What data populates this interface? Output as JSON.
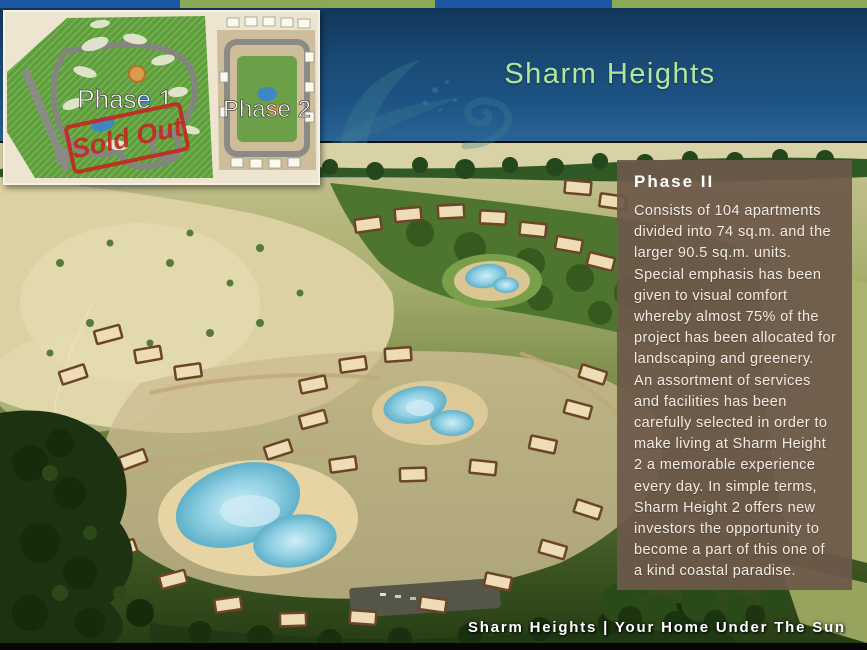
{
  "slide": {
    "title": "Sharm Heights",
    "tagline": "Sharm Heights | Your Home Under The Sun"
  },
  "site_map": {
    "phase1_label": "Phase 1",
    "phase2_label": "Phase 2",
    "sold_out_stamp": "Sold Out"
  },
  "info_panel": {
    "heading": "Phase II",
    "paragraph1": "Consists of 104 apartments divided into 74 sq.m. and the larger 90.5 sq.m. units. Special emphasis has been given to visual comfort whereby almost 75% of the project has been allocated for landscaping and greenery.",
    "paragraph2": "An assortment of services and facilities has been carefully selected in order to make living at Sharm Height 2 a memorable experience every day. In simple terms, Sharm Height 2 offers new investors the opportunity to become a part of this one of a kind coastal paradise."
  },
  "colors": {
    "title_text": "#b2e79b",
    "header_top": "#12365a",
    "header_bottom": "#2a6496",
    "strip_blue": "#1e57a4",
    "strip_green": "#8caa55",
    "panel_bg": "#6d584a",
    "stamp_red": "#c22a20",
    "pool_blue": "#8ecfe2"
  }
}
